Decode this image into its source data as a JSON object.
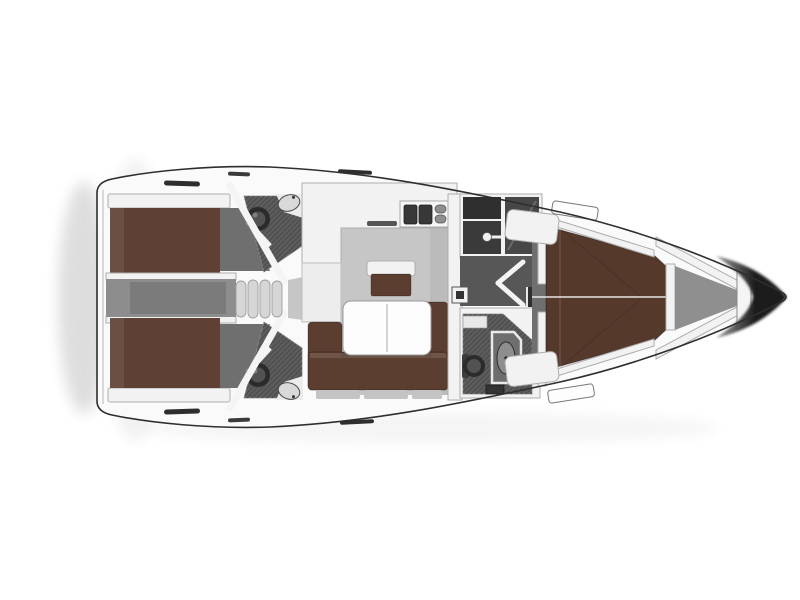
{
  "diagram": {
    "type": "yacht-interior-floor-plan",
    "view": "top-down",
    "orientation": {
      "bow": "right",
      "stern": "left"
    },
    "rooms": [
      "aft-cabin-port",
      "aft-cabin-starboard",
      "aft-head-port",
      "aft-head-starboard",
      "companionway-steps",
      "engine-corridor",
      "saloon",
      "galley",
      "navigation-seat",
      "wardrobe",
      "forward-head",
      "forward-cabin",
      "anchor-locker"
    ],
    "fixtures": [
      "double-berth-port",
      "double-berth-starboard",
      "v-berth",
      "u-shaped-sofa",
      "folding-table",
      "galley-double-sink",
      "toilet-x3",
      "washbasin-x2",
      "shower-tray",
      "deck-hatch-x2",
      "bow-pulpit"
    ]
  },
  "colors": {
    "background": "#ffffff",
    "hull_fill": "#fafafa",
    "hull_outline": "#2e2e2e",
    "wall": "#f2f2f2",
    "wall_stroke": "#aeaeae",
    "berth_aft": "#5e4134",
    "berth_fwd": "#55392b",
    "sofa": "#5b3e2f",
    "seat_base": "#c4c4c4",
    "salon_floor": "#c6c6c6",
    "corridor": "#8d8d8d",
    "cabin_floor": "#6f6f6f",
    "head_floor": "#5d5d5d",
    "hatch_line": "#4b4b4b",
    "passage_floor": "#575757",
    "wardrobe_dark": "#3a3a3a",
    "compartment_dark": "#2f2f2f",
    "steps": "#d6d6d6",
    "table": "#fdfdfd",
    "sink_basin": "#383838",
    "fixture_dark": "#2b2b2b",
    "fixture_mid": "#525252",
    "sink_light": "#d9d9d9",
    "shower_tray": "#8e8e8e",
    "anchor_floor": "#8f8f8f",
    "bow_dark": "#1d1d1d",
    "bow_fade": "#9a9a9a",
    "shadow": "#000000"
  }
}
